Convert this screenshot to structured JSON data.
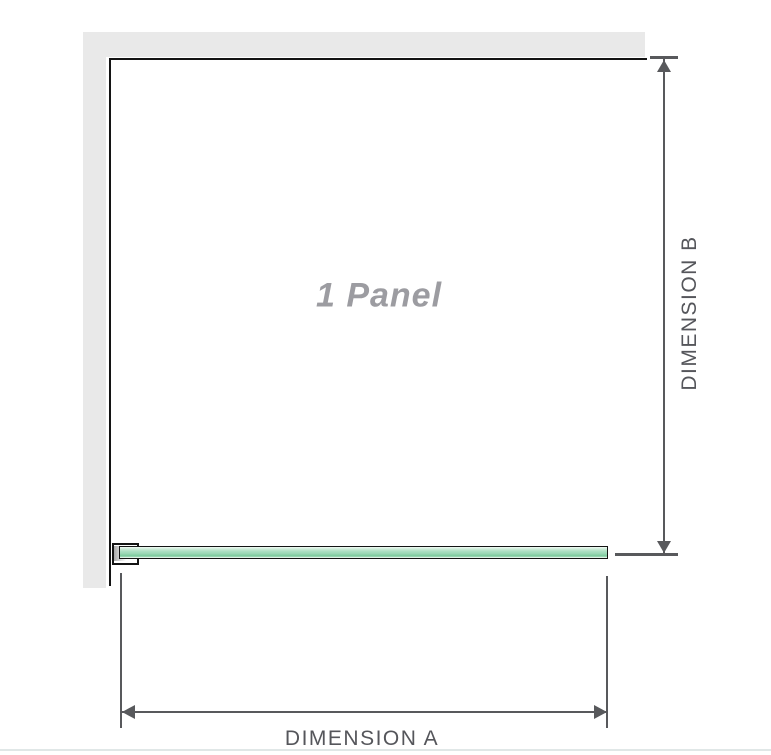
{
  "diagram": {
    "title": "1 Panel shower screen dimension diagram",
    "panel_label": "1 Panel",
    "dimension_a_label": "DIMENSION A",
    "dimension_b_label": "DIMENSION B"
  },
  "colors": {
    "background": "#ffffff",
    "wall_gray": "#e9e9e9",
    "panel_outline_black": "#141414",
    "dimension_line_gray": "#58595c",
    "dimension_label_text": "#55565b",
    "panel_label_text": "#9c9ca1",
    "glass_green_light": "#cdecd9",
    "glass_green_mid": "#9bd8b5",
    "glass_green_dark": "#7fcc9f",
    "bracket_shading_gray": "#a9a9a9",
    "page_divider": "#e0e7e7"
  }
}
